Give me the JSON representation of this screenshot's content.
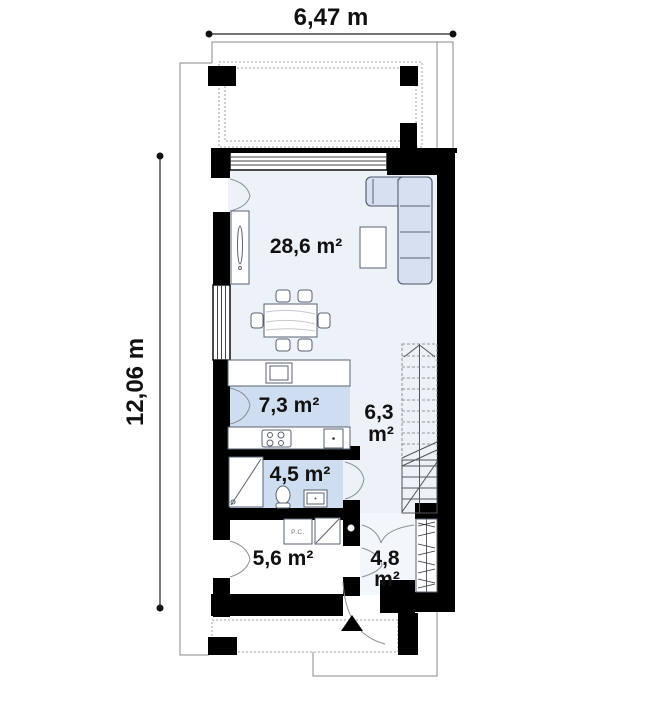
{
  "plan": {
    "dimensions": {
      "width": "6,47 m",
      "height": "12,06 m"
    },
    "rooms": [
      {
        "id": "living-dining-room",
        "label": "28,6 m²"
      },
      {
        "id": "kitchen",
        "label": "7,3 m²"
      },
      {
        "id": "stair-hall",
        "label": "6,3 m²",
        "lines": [
          "6,3",
          "m²"
        ]
      },
      {
        "id": "bathroom",
        "label": "4,5 m²"
      },
      {
        "id": "utility-room",
        "label": "5,6 m²"
      },
      {
        "id": "entry-hall",
        "label": "4,8 m²",
        "lines": [
          "4,8",
          "m²"
        ]
      }
    ],
    "equipment": {
      "boiler": "P.C."
    },
    "colors": {
      "wall": "#000000",
      "floor_main": "#edf2f9",
      "floor_wet": "#cfddf0",
      "floor_entry": "#f3f6fb",
      "sofa": "#d6e0f1",
      "outline": "#8a8a8a"
    }
  }
}
